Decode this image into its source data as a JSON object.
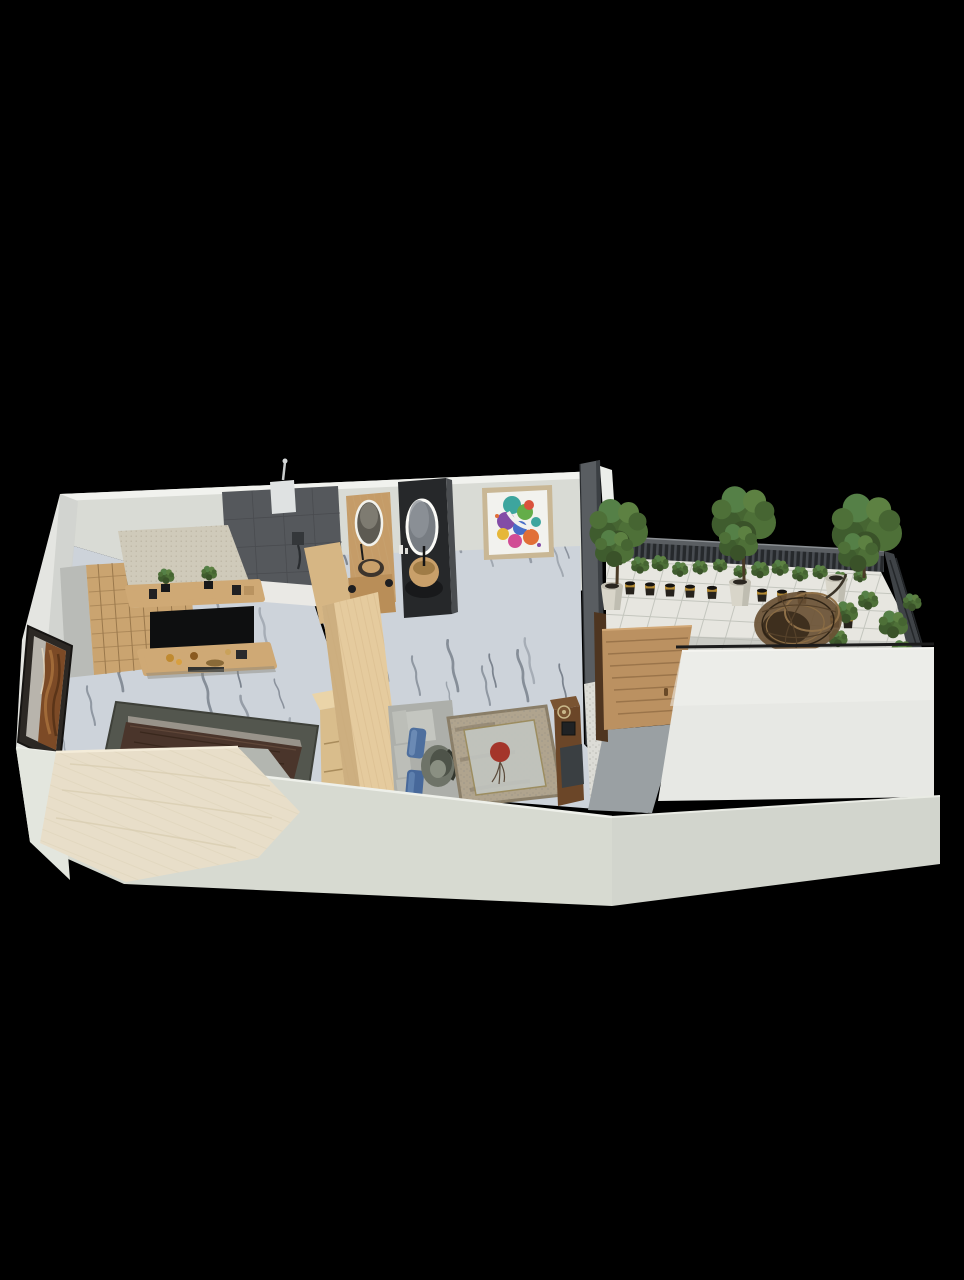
{
  "scene": {
    "type": "3d-floor-plan-render",
    "description": "Isometric top-down 3D rendering of a one-bedroom apartment with terrace, floating on a black background",
    "rooms": [
      {
        "name": "bedroom",
        "objects": [
          "wood-lattice-wardrobe",
          "tv-feature-wall",
          "wall-mounted-tv",
          "floating-shelves",
          "shelf-plants",
          "decor-vases",
          "bed-cream-duvet",
          "dark-brown-throw-blanket",
          "gray-area-rug",
          "wood-dresser",
          "framed-driftwood-artwork",
          "marble-floor"
        ]
      },
      {
        "name": "bathroom",
        "objects": [
          "rain-shower-head",
          "dark-tile-shower-wall",
          "shower-mixer",
          "half-wall-ledge",
          "wood-vanity-panel",
          "oval-led-mirror",
          "round-wood-basin",
          "dark-vanity-panel",
          "second-oval-led-mirror",
          "second-round-basin"
        ]
      },
      {
        "name": "living-area",
        "objects": [
          "colorful-abstract-wall-art",
          "gray-modular-sofa",
          "blue-throw-pillows",
          "fabric-armchair",
          "distressed-rug-red-medallion",
          "wood-media-console",
          "white-quartz-column",
          "wood-slat-wall",
          "marble-floor"
        ]
      },
      {
        "name": "terrace",
        "objects": [
          "slatted-metal-railing",
          "hedge-planters",
          "row-of-planter-pots",
          "white-planter-pots",
          "gold-planter-pots",
          "terrace-trees",
          "rattan-egg-chair",
          "side-shrubs",
          "ceramic-tile-floor",
          "wood-entry-door",
          "gray-hallway-wall"
        ]
      }
    ]
  },
  "palette": {
    "bg": "#000000",
    "backWall": "#d9dbd5",
    "wallTop": "#f1f2ee",
    "leftWall": "#e4e5e1",
    "leftWallInner": "#cfd1cd",
    "frontWallLeft": "#d7dad1",
    "frontWallRight": "#d2d5cd",
    "bigRightWall": "#e7e8e4",
    "marble": "#cdd3da",
    "marbleVein": "#5f6874",
    "terraceTile": "#e7e6e0",
    "tileLine": "#c4c6be",
    "railingDark": "#2b2e31",
    "railingTopFace": "#5a5e62",
    "partitionGray": "#595d61",
    "darkShowerTile": "#55585c",
    "ledgeWhite": "#eae9e5",
    "woodVanity": "#c59c68",
    "vanityDark": "#26282a",
    "mirrorGlass": "#787d83",
    "basinTan": "#c9a06a",
    "panelBeige": "#cfcaba",
    "shelfWood": "#cfa975",
    "tvBlack": "#0e0f10",
    "latticeWood": "#caa470",
    "grayColumn": "#b9bbb7",
    "woodWallLight": "#e5cb9e",
    "woodWallMid": "#d6b684",
    "rugBedroom": "#53564e",
    "blanket": "#4a352b",
    "mattressEdge": "#98938a",
    "duvet": "#e8dec9",
    "bedSidePanel": "#b3b6b0",
    "dresserTop": "#ead4a8",
    "dresserFront": "#d9bd8c",
    "artFrameDark": "#2c2824",
    "artRust": "#7c4a26",
    "sofaGray": "#adafaa",
    "cushionGray": "#bcbeb8",
    "pillowBlue": "#4e6f9e",
    "armchair": "#6e7368",
    "rugLiving": "#b0a48e",
    "rugInnerPanel": "#c3c7c2",
    "rugRedMedallion": "#a4352a",
    "consoleWood": "#6b4628",
    "consoleDarkPanel": "#3a3f42",
    "quartzWhite": "#dcdcd6",
    "slatWood": "#8a5c34",
    "doorWood": "#bb9161",
    "doorFrame": "#4e3520",
    "hallwayGray": "#9aa0a3",
    "endWallSliver": "#eceeea",
    "potWhite": "#d8d5c9",
    "potGold": "#b08833",
    "potDark": "#26221c",
    "green1": "#4e7038",
    "green2": "#3f5c2e",
    "green3": "#5d8142",
    "rattan": "#6a5134",
    "artTeal": "#2e9f98",
    "artPurple": "#7a3fa0",
    "artOrange": "#e06428",
    "artBlue": "#3a62c4",
    "artMagenta": "#cf3f8e",
    "artYellow": "#e6b32a",
    "artGreen": "#59a83c",
    "artFrameLight": "#c9b795"
  }
}
